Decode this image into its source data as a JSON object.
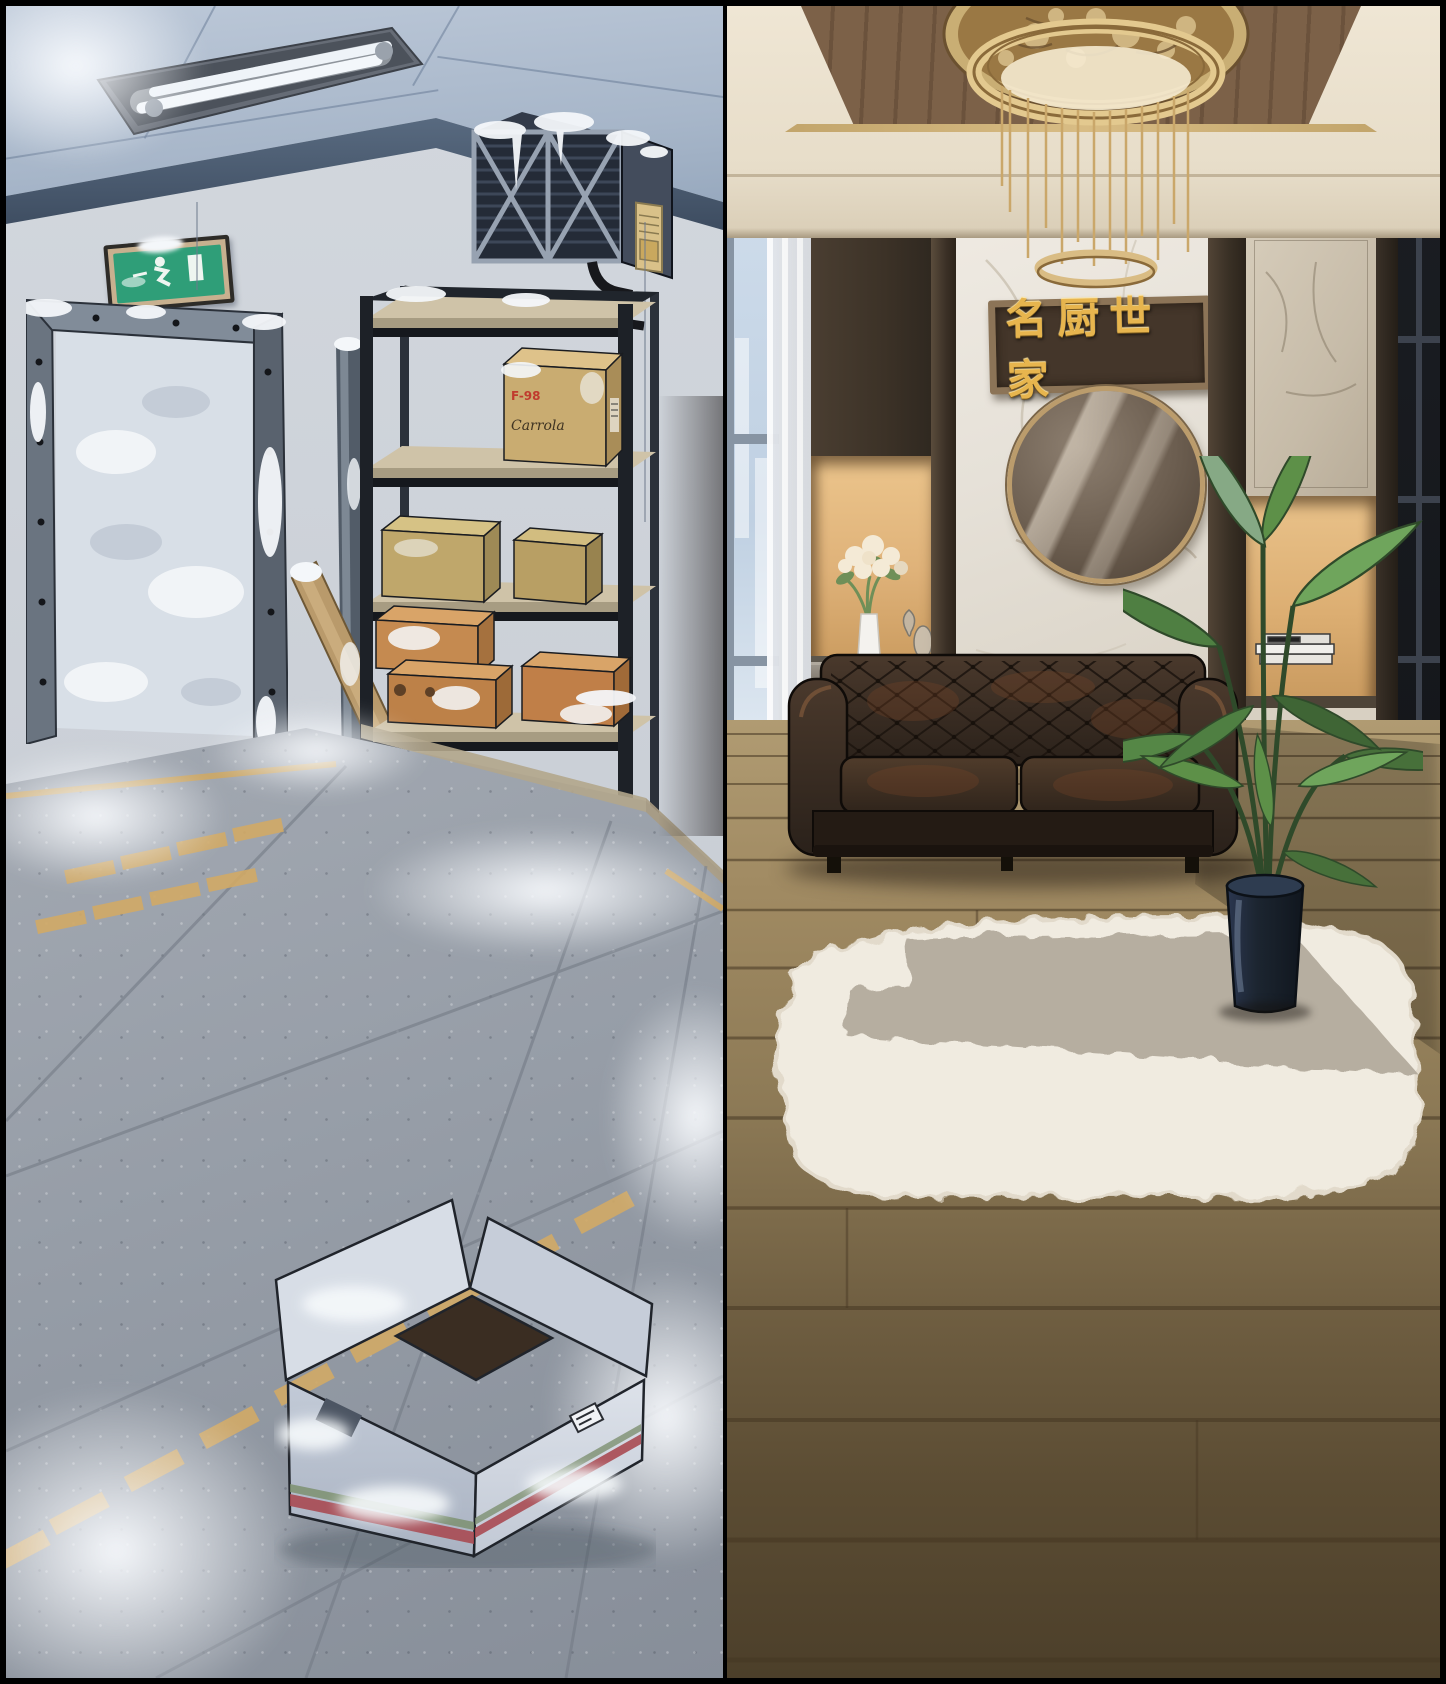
{
  "scene": {
    "format": "two-panel background illustration",
    "border_color": "#000000"
  },
  "left_scene": {
    "description": "Frost-covered cold storage room with metal door frame, exit sign, shelving with cardboard boxes and yellow floor lane markings",
    "exit_sign": {
      "face_color": "#2f9e78",
      "frame_color": "#c7b08f",
      "pictogram": "running-man"
    },
    "shelf": {
      "frame_color": "#20252c",
      "board_color": "#cfc3a8",
      "top_box": {
        "label": "F-98",
        "brand": "Carrola",
        "color": "#c9ac71"
      },
      "khaki_box_color": "#bfa76b",
      "orange_box_color": "#c58a50",
      "bottom_box_color": "#9a5e44"
    },
    "floor": {
      "tile_color": "#99a0aa",
      "marking_color": "#d2aa66",
      "frost_color": "#f2f5f8"
    },
    "foreground_box_color": "#ccd3df"
  },
  "right_scene": {
    "description": "Upscale lounge with gold ring chandelier, marble feature wall, wooden plaque, round mirror, leather chesterfield sofa, potted plant and white fur rug",
    "plaque": {
      "text": "名厨世家",
      "text_color": "#e7b54e",
      "board_color": "#44362a",
      "frame_color": "#8c7457"
    },
    "chandelier": {
      "gold_color": "#d9c08c",
      "hanging_rods": 13
    },
    "sofa_color": "#33271f",
    "rug_color": "#f1ece1",
    "wood_floor_color": "#a08a62",
    "plant_pot_color": "#1c2530",
    "niche_glow_color": "#dfb279"
  }
}
